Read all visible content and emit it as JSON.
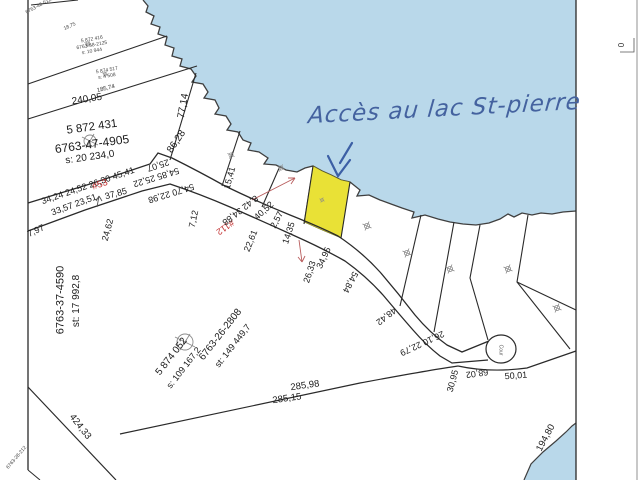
{
  "map": {
    "type": "cadastral-survey-plan",
    "water_color": "#b9d8ea",
    "highlight_color": "#e9e136",
    "line_color": "#2a2a2a",
    "red_lot_color": "#c23030"
  },
  "annotation": {
    "handwriting": "Accès au lac St-pierre",
    "color": "#44629f"
  },
  "labels": [
    {
      "n": "dist-240-05",
      "t": "240,05",
      "x": 87,
      "y": 100,
      "r": -9,
      "s": 10
    },
    {
      "n": "dist-77-14",
      "t": "77,14",
      "x": 184,
      "y": 106,
      "r": -80,
      "s": 10
    },
    {
      "n": "dist-86-28",
      "t": "86,28",
      "x": 177,
      "y": 142,
      "r": -56,
      "s": 10
    },
    {
      "n": "road-segments-north",
      "t": "34,24 24,52 26,30 45,41",
      "x": 88,
      "y": 186,
      "r": -19,
      "s": 9
    },
    {
      "n": "dist-25-07",
      "t": "25,07",
      "x": 158,
      "y": 165,
      "r": 162,
      "s": 9
    },
    {
      "n": "dist-54-85-25-22",
      "t": "54,85 25,22",
      "x": 156,
      "y": 177,
      "r": 163,
      "s": 9
    },
    {
      "n": "dist-54-70-22-98",
      "t": "54,70 22,98",
      "x": 171,
      "y": 193,
      "r": 163,
      "s": 9
    },
    {
      "n": "dist-33-57-23-51",
      "t": "33,57 23,51",
      "x": 74,
      "y": 205,
      "r": -20,
      "s": 9
    },
    {
      "n": "dist-7-97",
      "t": "7,97",
      "x": 36,
      "y": 231,
      "r": -25,
      "s": 9
    },
    {
      "n": "dist-37-85",
      "t": "37,85",
      "x": 116,
      "y": 194,
      "r": -15,
      "s": 9
    },
    {
      "n": "dist-24-62",
      "t": "24,62",
      "x": 108,
      "y": 230,
      "r": -75,
      "s": 9
    },
    {
      "n": "lot-number-53",
      "t": "#53",
      "x": 100,
      "y": 185,
      "r": -19,
      "s": 9.5,
      "c": "#c23030"
    },
    {
      "n": "lot-number-112",
      "t": "#112",
      "x": 225,
      "y": 227,
      "r": 145,
      "s": 9,
      "c": "#c23030"
    },
    {
      "n": "dist-15-41",
      "t": "15,41",
      "x": 230,
      "y": 178,
      "r": -75,
      "s": 9
    },
    {
      "n": "dist-8-42-34-88",
      "t": "8,42 34,88",
      "x": 240,
      "y": 210,
      "r": 142,
      "s": 9
    },
    {
      "n": "dist-40-52",
      "t": "40,52",
      "x": 264,
      "y": 211,
      "r": -42,
      "s": 9
    },
    {
      "n": "dist-2-57",
      "t": "2,57",
      "x": 277,
      "y": 220,
      "r": -62,
      "s": 9
    },
    {
      "n": "dist-22-61",
      "t": "22,61",
      "x": 251,
      "y": 241,
      "r": -68,
      "s": 9
    },
    {
      "n": "dist-7-12",
      "t": "7,12",
      "x": 194,
      "y": 219,
      "r": -78,
      "s": 9
    },
    {
      "n": "dist-14-35",
      "t": "14,35",
      "x": 289,
      "y": 233,
      "r": -72,
      "s": 9
    },
    {
      "n": "dist-26-33",
      "t": "26,33",
      "x": 310,
      "y": 272,
      "r": -72,
      "s": 9
    },
    {
      "n": "dist-34-95",
      "t": "34,95",
      "x": 324,
      "y": 258,
      "r": -65,
      "s": 9
    },
    {
      "n": "dist-54-84",
      "t": "54,84",
      "x": 350,
      "y": 282,
      "r": 118,
      "s": 9
    },
    {
      "n": "dist-48-42",
      "t": "48,42",
      "x": 386,
      "y": 316,
      "r": 142,
      "s": 9
    },
    {
      "n": "dist-26-10-22-79",
      "t": "26,10 22,79",
      "x": 422,
      "y": 343,
      "r": 155,
      "s": 9
    },
    {
      "n": "dist-30-95",
      "t": "30,95",
      "x": 453,
      "y": 381,
      "r": -75,
      "s": 9
    },
    {
      "n": "dist-68-02",
      "t": "68,02",
      "x": 477,
      "y": 373,
      "r": 172,
      "s": 9
    },
    {
      "n": "dist-50-01",
      "t": "50,01",
      "x": 516,
      "y": 376,
      "r": -4,
      "s": 9
    },
    {
      "n": "dist-285-98",
      "t": "285,98",
      "x": 305,
      "y": 386,
      "r": -8,
      "s": 9.5
    },
    {
      "n": "dist-285-15",
      "t": "285,15",
      "x": 287,
      "y": 399,
      "r": -8,
      "s": 9.5
    },
    {
      "n": "dist-424-33",
      "t": "424,33",
      "x": 80,
      "y": 427,
      "r": 52,
      "s": 9.5
    },
    {
      "n": "dist-194-80",
      "t": "194,80",
      "x": 546,
      "y": 438,
      "r": -62,
      "s": 9.5
    },
    {
      "n": "culdesac-label",
      "t": "Cour",
      "x": 500,
      "y": 350,
      "r": 90,
      "s": 5,
      "c": "#555555"
    },
    {
      "n": "lot-id-5872431",
      "t": "5 872 431",
      "x": 92,
      "y": 128,
      "r": -8,
      "s": 11.5
    },
    {
      "n": "lot-id-6763-47-4905",
      "t": "6763-47-4905",
      "x": 92,
      "y": 144,
      "r": -8,
      "s": 12
    },
    {
      "n": "lot-area-20234",
      "t": "s: 20 234,0",
      "x": 90,
      "y": 158,
      "r": -8,
      "s": 10
    },
    {
      "n": "lot-id-6763-37-4590",
      "t": "6763-37-4590",
      "x": 61,
      "y": 300,
      "r": -90,
      "s": 11
    },
    {
      "n": "lot-area-17992",
      "t": "st: 17 992,8",
      "x": 77,
      "y": 301,
      "r": -90,
      "s": 10
    },
    {
      "n": "lot-id-5874052",
      "t": "5 874 052",
      "x": 172,
      "y": 357,
      "r": -52,
      "s": 10
    },
    {
      "n": "lot-area-109167",
      "t": "s: 109 167,2",
      "x": 184,
      "y": 368,
      "r": -52,
      "s": 9
    },
    {
      "n": "lot-id-6763-26-2808",
      "t": "6763-26-2808",
      "x": 221,
      "y": 335,
      "r": -52,
      "s": 10
    },
    {
      "n": "lot-area-149449",
      "t": "st: 149 449,7",
      "x": 233,
      "y": 346,
      "r": -52,
      "s": 9
    },
    {
      "n": "tiny-lot-top-corner",
      "t": "6763-48-5125",
      "x": 40,
      "y": 6,
      "r": -28,
      "s": 5,
      "c": "#444444"
    },
    {
      "n": "tiny-lot-a-1",
      "t": "5 872 416",
      "x": 92,
      "y": 40,
      "r": -10,
      "s": 5,
      "c": "#444444"
    },
    {
      "n": "tiny-lot-a-2",
      "t": "6763-58-2125",
      "x": 92,
      "y": 46,
      "r": -10,
      "s": 5,
      "c": "#444444"
    },
    {
      "n": "tiny-lot-a-3",
      "t": "s: 10 944",
      "x": 92,
      "y": 52,
      "r": -10,
      "s": 5,
      "c": "#444444"
    },
    {
      "n": "tiny-lot-b-1",
      "t": "5 874 517",
      "x": 107,
      "y": 71,
      "r": -10,
      "s": 5,
      "c": "#444444"
    },
    {
      "n": "tiny-lot-b-2",
      "t": "s: 4 508",
      "x": 107,
      "y": 77,
      "r": -10,
      "s": 5,
      "c": "#444444"
    },
    {
      "n": "tiny-dist-185-74",
      "t": "185,74",
      "x": 106,
      "y": 89,
      "r": -14,
      "s": 6,
      "c": "#333333"
    },
    {
      "n": "tiny-dist-18-75",
      "t": "18,75",
      "x": 70,
      "y": 27,
      "r": -24,
      "s": 5,
      "c": "#444444"
    },
    {
      "n": "tiny-lot-bottom-corner",
      "t": "6763-28-212",
      "x": 17,
      "y": 458,
      "r": -50,
      "s": 5,
      "c": "#444444"
    },
    {
      "n": "margin-mark-0",
      "t": "0",
      "x": 622,
      "y": 45,
      "r": -90,
      "s": 8,
      "c": "#333333"
    }
  ]
}
